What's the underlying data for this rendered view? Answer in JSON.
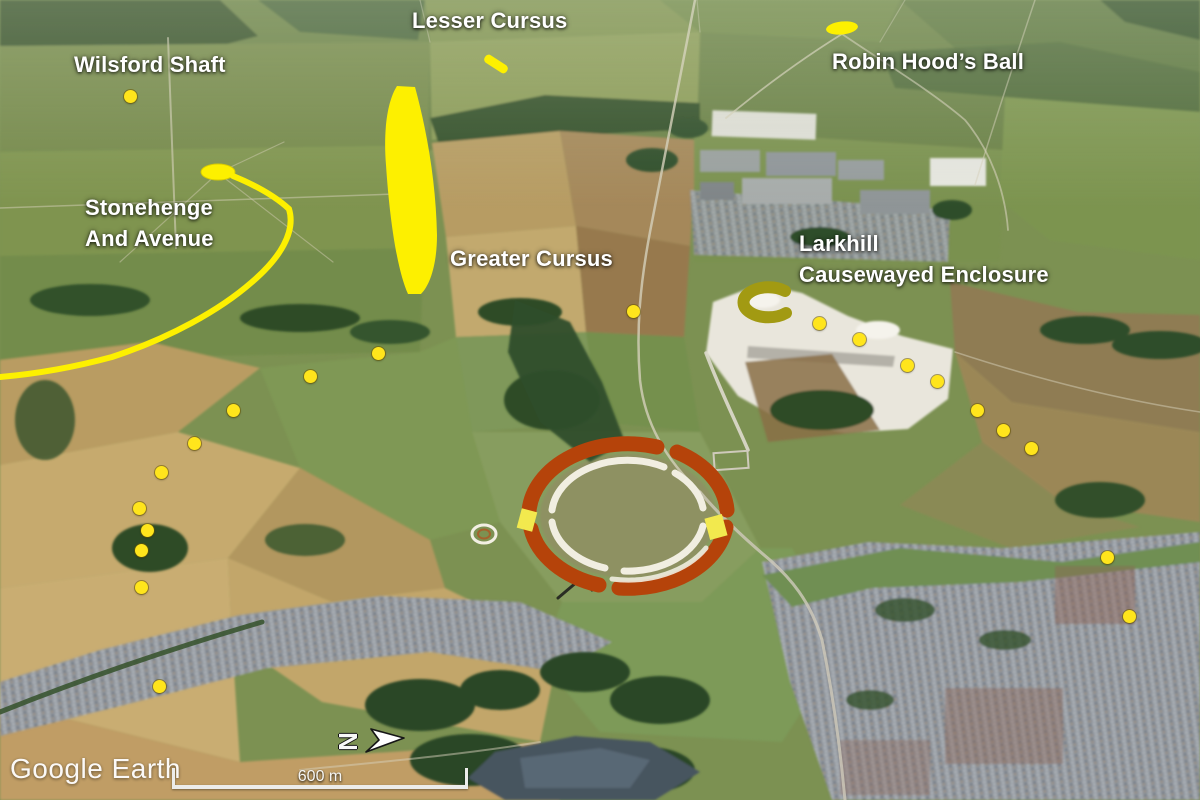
{
  "branding": {
    "logo_text": "Google Earth"
  },
  "scale_bar": {
    "label": "600 m"
  },
  "compass": {
    "letter": "N"
  },
  "labels": {
    "wilsford_shaft": "Wilsford Shaft",
    "lesser_cursus": "Lesser Cursus",
    "robin_hoods_ball": "Robin Hood’s Ball",
    "stonehenge_line1": "Stonehenge",
    "stonehenge_line2": "And Avenue",
    "greater_cursus": "Greater Cursus",
    "larkhill_line1": "Larkhill",
    "larkhill_line2": "Causewayed Enclosure"
  },
  "colors": {
    "annotation_yellow": "#fdf000",
    "dot_yellow": "#ffe51c",
    "ring_orange": "#b5430a",
    "ring_white": "#f1eee1",
    "gap_yellow": "#f2e94e",
    "enclosure_olive": "#a29a12",
    "label_text": "#ffffff"
  },
  "map": {
    "site_dots": [
      [
        130,
        96
      ],
      [
        378,
        353
      ],
      [
        310,
        376
      ],
      [
        233,
        410
      ],
      [
        194,
        443
      ],
      [
        161,
        472
      ],
      [
        139,
        508
      ],
      [
        147,
        530
      ],
      [
        141,
        550
      ],
      [
        141,
        587
      ],
      [
        159,
        686
      ],
      [
        633,
        311
      ],
      [
        819,
        323
      ],
      [
        859,
        339
      ],
      [
        907,
        365
      ],
      [
        937,
        381
      ],
      [
        977,
        410
      ],
      [
        1003,
        430
      ],
      [
        1031,
        448
      ],
      [
        1107,
        557
      ],
      [
        1129,
        616
      ]
    ]
  }
}
